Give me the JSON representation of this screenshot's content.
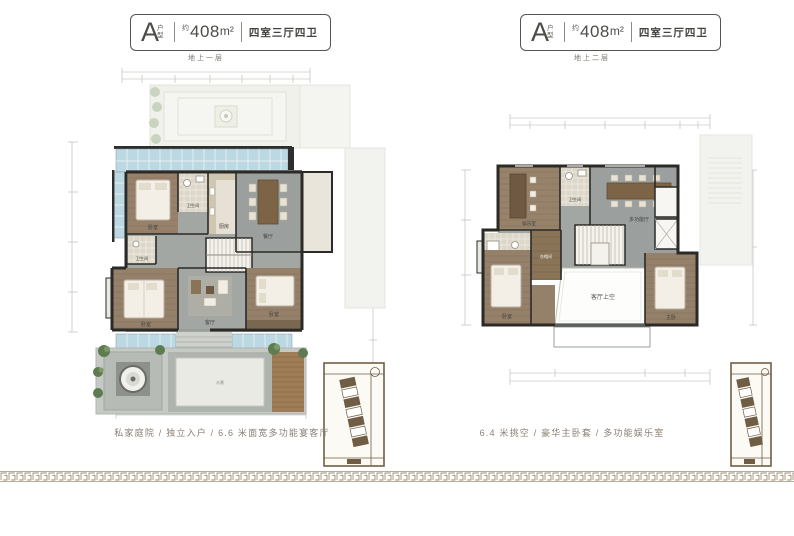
{
  "plans": [
    {
      "badge": {
        "letter": "A",
        "letter_suffix": "户型",
        "area_prefix": "约",
        "area": "408",
        "area_unit": "m²",
        "layout": "四室三厅四卫"
      },
      "floor_label": "地上一层",
      "caption": "私家庭院 / 独立入户 / 6.6 米面宽多功能宴客厅",
      "rooms": {
        "bedroom_a": "卧室",
        "bath_1": "卫生间",
        "kitchen": "厨房",
        "dining": "餐厅",
        "bath_2": "卫生间",
        "bedroom_b": "卧室",
        "living": "客厅",
        "bedroom_c": "卧室",
        "water_feature": "水景"
      }
    },
    {
      "badge": {
        "letter": "A",
        "letter_suffix": "户型",
        "area_prefix": "约",
        "area": "408",
        "area_unit": "m²",
        "layout": "四室三厅四卫"
      },
      "floor_label": "地上二层",
      "caption": "6.4 米挑空 / 豪华主卧套 / 多功能娱乐室",
      "rooms": {
        "lounge": "娱乐室",
        "bath_1": "卫生间",
        "multi_hall": "多功能厅",
        "bath_2": "卫生间",
        "cloak": "衣帽间",
        "bedroom": "卧室",
        "void": "客厅上空",
        "master": "主卧"
      }
    }
  ],
  "colors": {
    "wall": "#2b2a27",
    "wood_floor": "#97816a",
    "stone_floor": "#9ba09e",
    "tile": "#ddd7c9",
    "glass": "#bcd8e2",
    "plant": "#5e7c4f",
    "ghost": "#eff1ea",
    "keymap_sepia": "#6f5e45",
    "border_gold": "#a2917a",
    "text_dark": "#4c4c48",
    "caption_text": "#8a7f72"
  },
  "icons": {
    "keymap_left": "site-plan-minimap",
    "keymap_right": "site-plan-minimap",
    "bottom_border": "greek-key-border"
  }
}
